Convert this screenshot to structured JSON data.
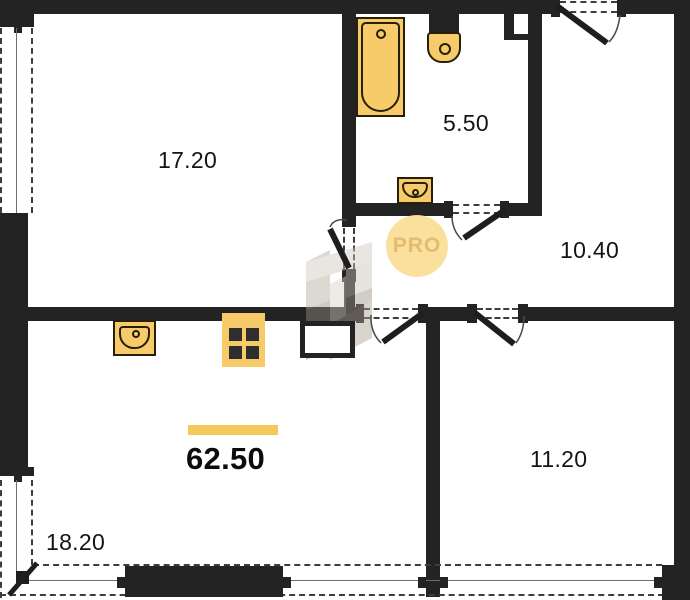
{
  "floorplan": {
    "watermark": {
      "label": "PRO"
    },
    "total_area": {
      "value": "62.50"
    },
    "rooms": [
      {
        "id": "living-room",
        "area": "17.20"
      },
      {
        "id": "bathroom",
        "area": "5.50"
      },
      {
        "id": "hallway",
        "area": "10.40"
      },
      {
        "id": "bedroom",
        "area": "11.20"
      },
      {
        "id": "kitchen-living",
        "area": "18.20"
      }
    ],
    "fixtures": [
      "bathtub-icon",
      "toilet-icon",
      "bath-sink-icon",
      "kitchen-sink-icon",
      "stove-icon"
    ],
    "colors": {
      "wall": "#232323",
      "fixture_fill": "#f7ca6a",
      "fixture_stroke": "#271f08",
      "accent_bar": "#f5c85b",
      "watermark_circle": "#fbdf98",
      "watermark_text": "#e0b96c"
    }
  }
}
